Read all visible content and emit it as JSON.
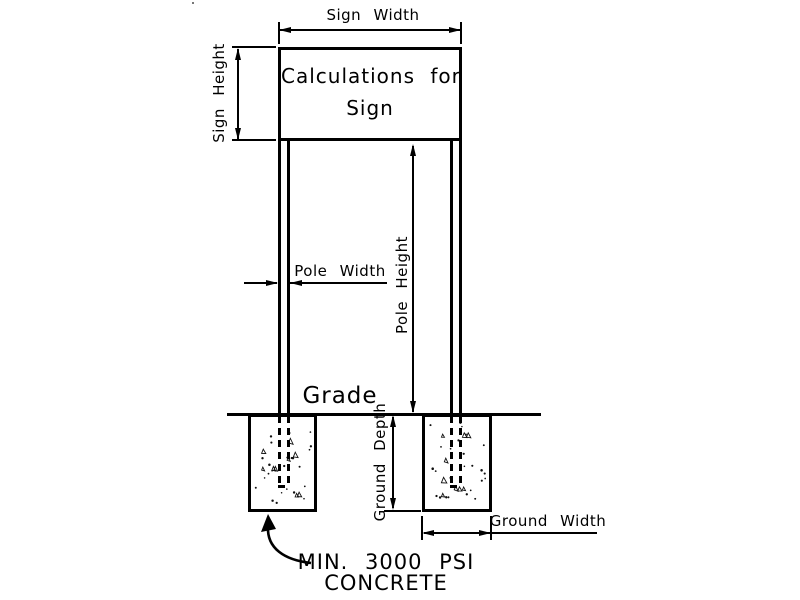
{
  "sign": {
    "line1": "Calculations for",
    "line2": "Sign"
  },
  "dimensions": {
    "sign_width": "Sign Width",
    "sign_height": "Sign Height",
    "pole_width": "Pole Width",
    "pole_height": "Pole Height",
    "ground_depth": "Ground Depth",
    "ground_width": "Ground Width"
  },
  "annotations": {
    "grade": "Grade",
    "concrete_line1": "MIN. 3000 PSI",
    "concrete_line2": "CONCRETE"
  },
  "colors": {
    "line": "#000000",
    "background": "#ffffff"
  }
}
